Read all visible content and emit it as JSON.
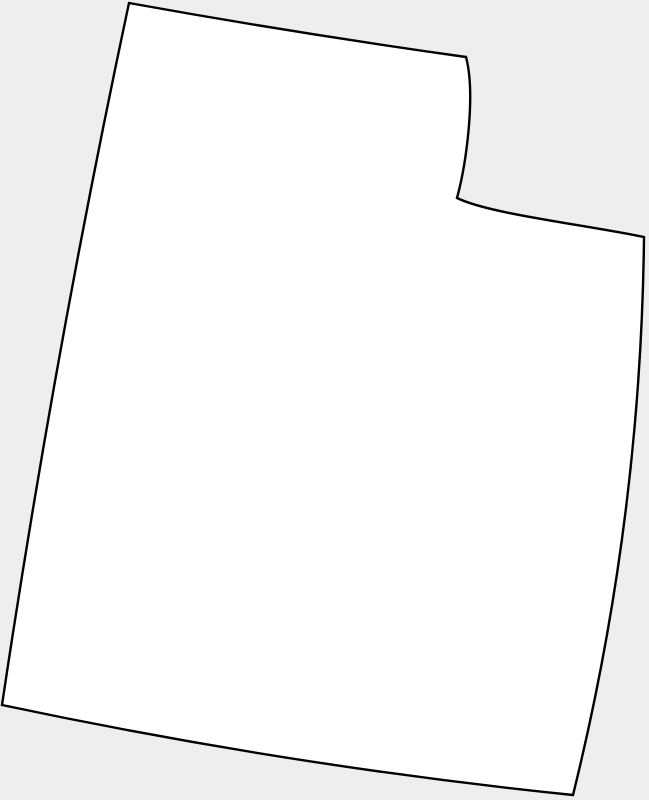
{
  "map": {
    "region": "Utah",
    "shape_name": "utah-state-outline",
    "colors": {
      "background": "#eeeeee",
      "fill": "#ffffff",
      "stroke": "#000000"
    },
    "stroke_width": "2.4",
    "outline_path": "M 129,3 Q 295,33 466,57 C 476,95 466,165 457,198 C 490,214 580,224 644,237 Q 641,520 573,795 Q 290,766 2,705 Q 55,350 129,3 Z"
  }
}
